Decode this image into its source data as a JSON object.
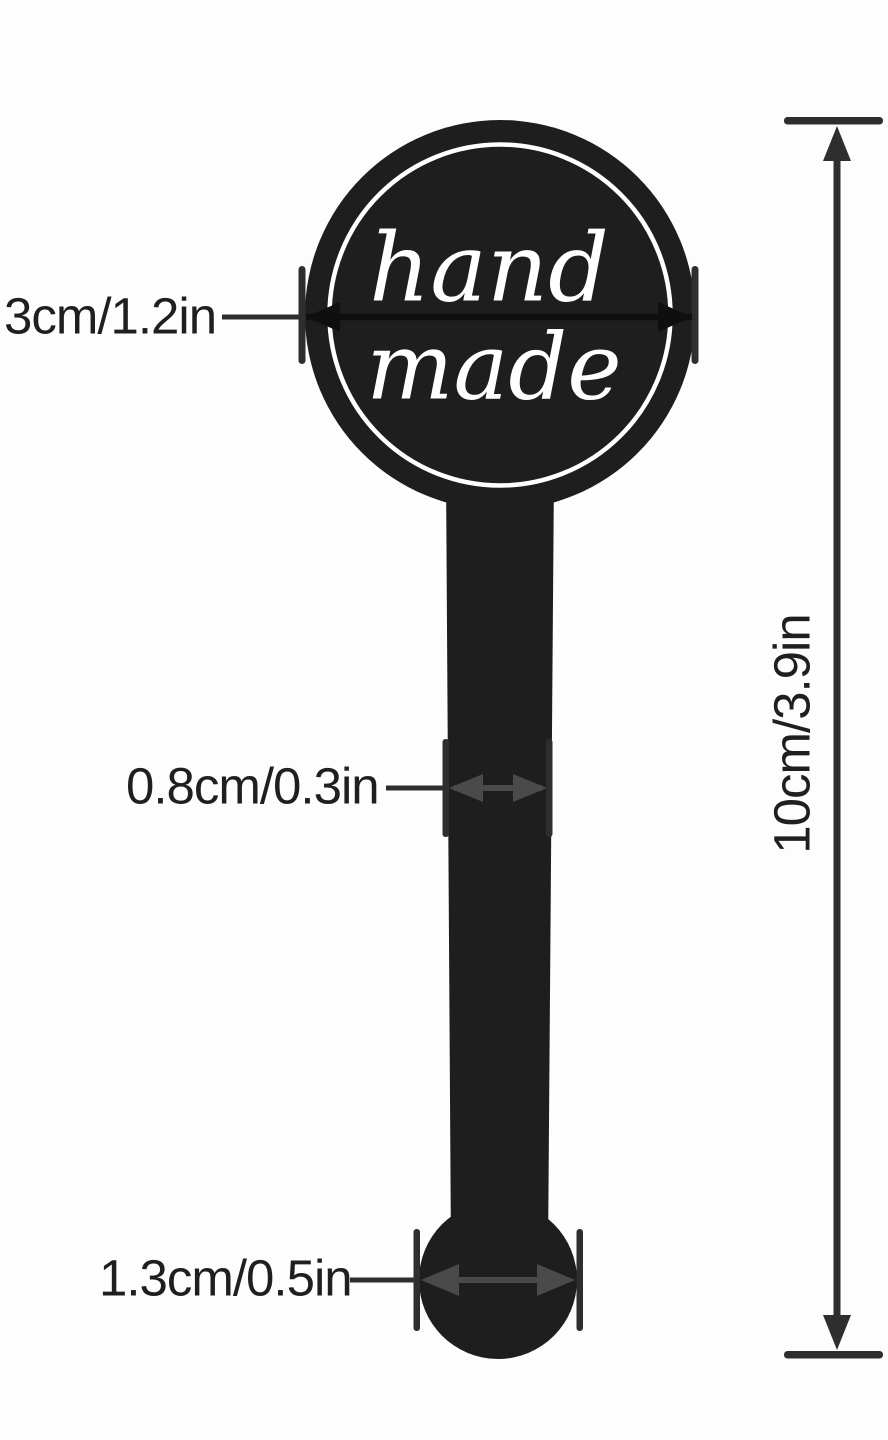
{
  "tag": {
    "script_line1": "hand",
    "script_line2": "made"
  },
  "dimensions": {
    "circle_width": "3cm/1.2in",
    "stem_width": "0.8cm/0.3in",
    "bottom_width": "1.3cm/0.5in",
    "total_height": "10cm/3.9in"
  },
  "colors": {
    "background": "#fdfdfd",
    "tag_black": "#1e1e1e",
    "crossing_band": "#0f0f0f",
    "dimension_dark": "#2e2e2e",
    "dimension_gray": "#4a4a4a",
    "script_white": "#ffffff",
    "label_text": "#1f1f1f"
  }
}
